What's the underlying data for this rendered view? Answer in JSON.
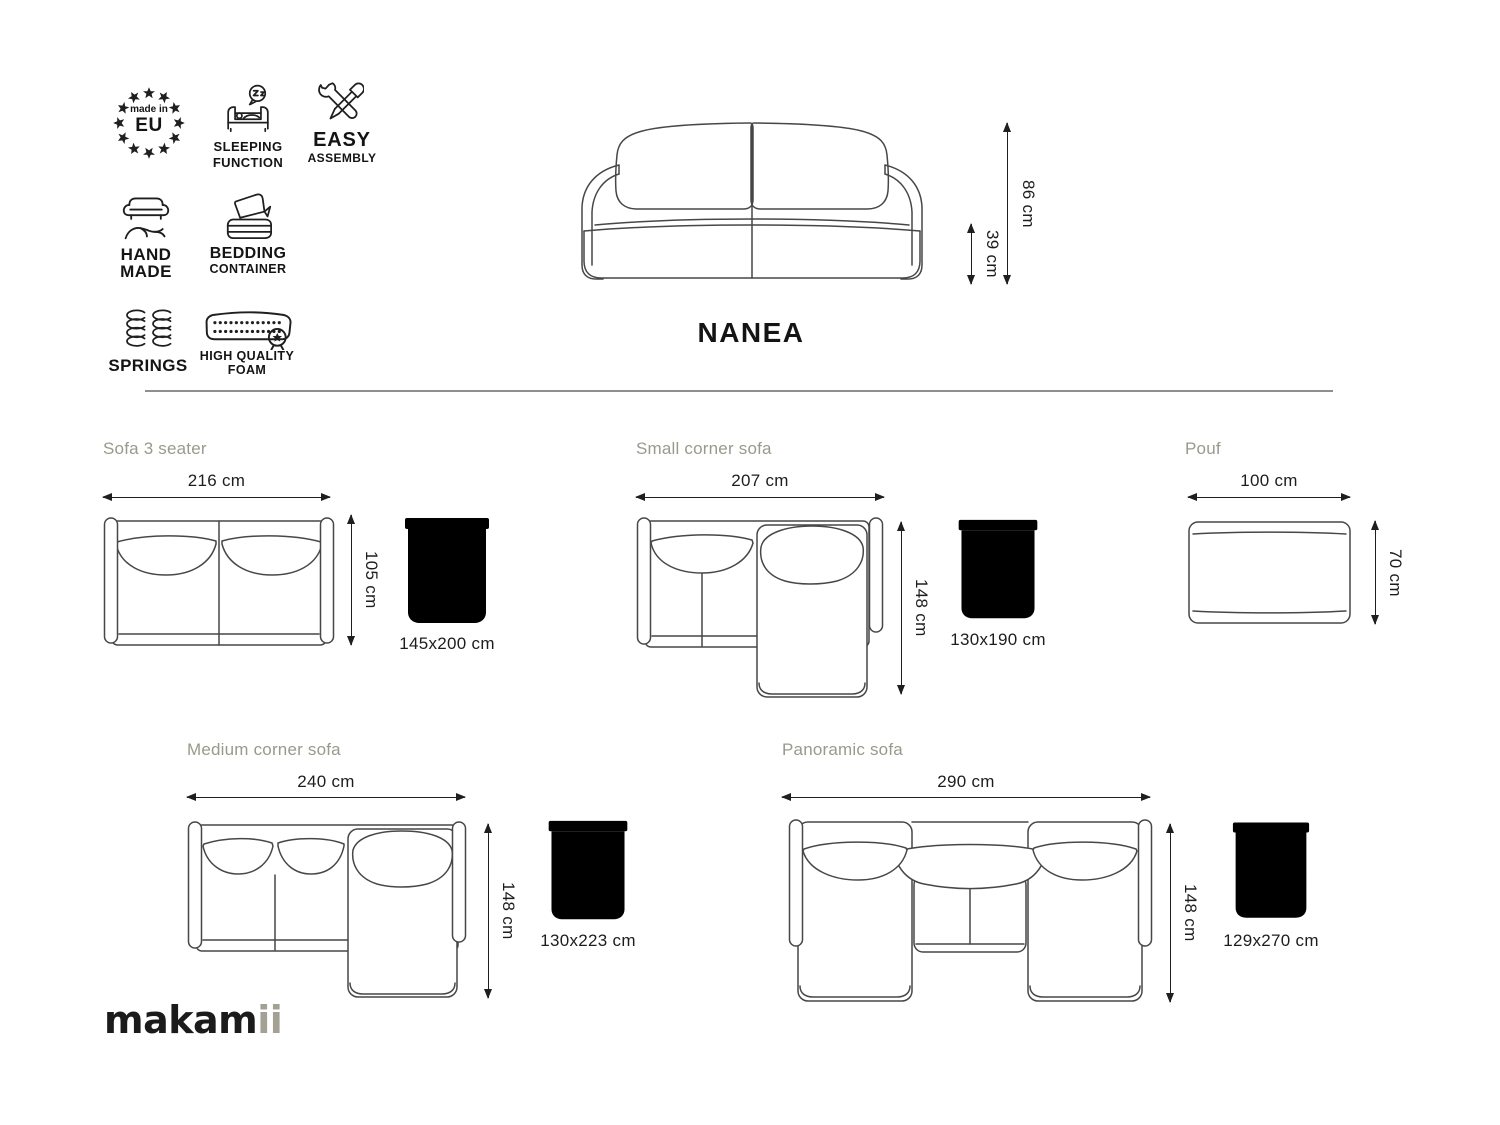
{
  "product": {
    "name": "NANEA",
    "total_height": "86 cm",
    "seat_height": "39 cm"
  },
  "feature_badges": {
    "eu": {
      "icon": "eu-stars-icon",
      "text_small": "made in",
      "text_big": "EU"
    },
    "sleeping": {
      "icon": "sleeping-function-icon",
      "line1": "SLEEPING",
      "line2": "FUNCTION"
    },
    "assembly": {
      "icon": "easy-assembly-icon",
      "line1": "EASY",
      "line2": "ASSEMBLY"
    },
    "handmade": {
      "icon": "hand-made-icon",
      "line1": "HAND",
      "line2": "MADE"
    },
    "bedding": {
      "icon": "bedding-container-icon",
      "line1": "BEDDING",
      "line2": "CONTAINER"
    },
    "springs": {
      "icon": "springs-icon",
      "line1": "SPRINGS"
    },
    "foam": {
      "icon": "high-quality-foam-icon",
      "line1": "HIGH QUALITY",
      "line2": "FOAM"
    }
  },
  "variants": {
    "sofa3": {
      "title": "Sofa 3 seater",
      "width": "216 cm",
      "depth": "105 cm",
      "bed_size": "145x200 cm"
    },
    "small_corner": {
      "title": "Small corner sofa",
      "width": "207 cm",
      "depth": "148 cm",
      "bed_size": "130x190 cm"
    },
    "pouf": {
      "title": "Pouf",
      "width": "100 cm",
      "depth": "70 cm"
    },
    "medium_corner": {
      "title": "Medium corner sofa",
      "width": "240 cm",
      "depth": "148 cm",
      "bed_size": "130x223 cm"
    },
    "panoramic": {
      "title": "Panoramic sofa",
      "width": "290 cm",
      "depth": "148 cm",
      "bed_size": "129x270 cm"
    }
  },
  "brand": {
    "logo_main": "makam",
    "logo_accent": "ii"
  },
  "colors": {
    "line_art": "#474747",
    "dimension_text": "#1d1d1d",
    "section_title": "#9a998c",
    "logo_accent": "#a3a094",
    "divider": "#8f8f8f"
  }
}
